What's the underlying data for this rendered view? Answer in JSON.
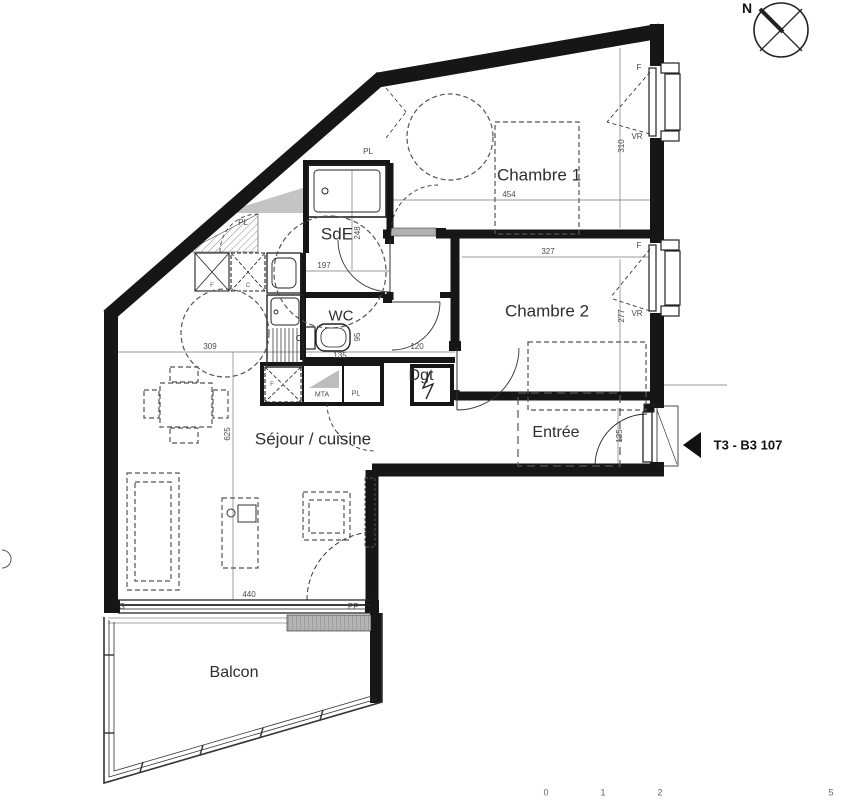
{
  "title": {
    "north": "N",
    "unit": "T3 - B3 107"
  },
  "rooms": {
    "chambre1": "Chambre 1",
    "chambre2": "Chambre 2",
    "sde": "SdE",
    "wc": "WC",
    "dgt": "Dgt",
    "entree": "Entrée",
    "sejour": "Séjour / cuisine",
    "balcon": "Balcon"
  },
  "closets": {
    "pl_shower": "PL",
    "pl_corner": "PL",
    "pl_hall": "PL",
    "mta": "MTA",
    "appliance_f_top": "F",
    "appliance_c_top": "C",
    "appliance_f_low": "F"
  },
  "windows": {
    "w1_type": "F",
    "w1_shutter": "VR",
    "w2_type": "F",
    "w2_shutter": "VR",
    "bay": "S",
    "french_door": "PF"
  },
  "dimensions": {
    "chambre1_width": "454",
    "chambre1_depth": "310",
    "chambre2_width": "327",
    "chambre2_depth": "277",
    "sde_depth": "248",
    "sde_width": "197",
    "kitchen_width": "309",
    "wc_width": "135",
    "wc_depth": "95",
    "dgt_width": "120",
    "sejour_depth": "625",
    "sejour_width": "440",
    "entry_width": "125"
  },
  "scale_bar": {
    "t0": "0",
    "t1": "1",
    "t2": "2",
    "t3": "5"
  },
  "colors": {
    "wall": "#1a1a1a",
    "thin_line": "#555555",
    "gray_fill": "#c2c2c2"
  }
}
